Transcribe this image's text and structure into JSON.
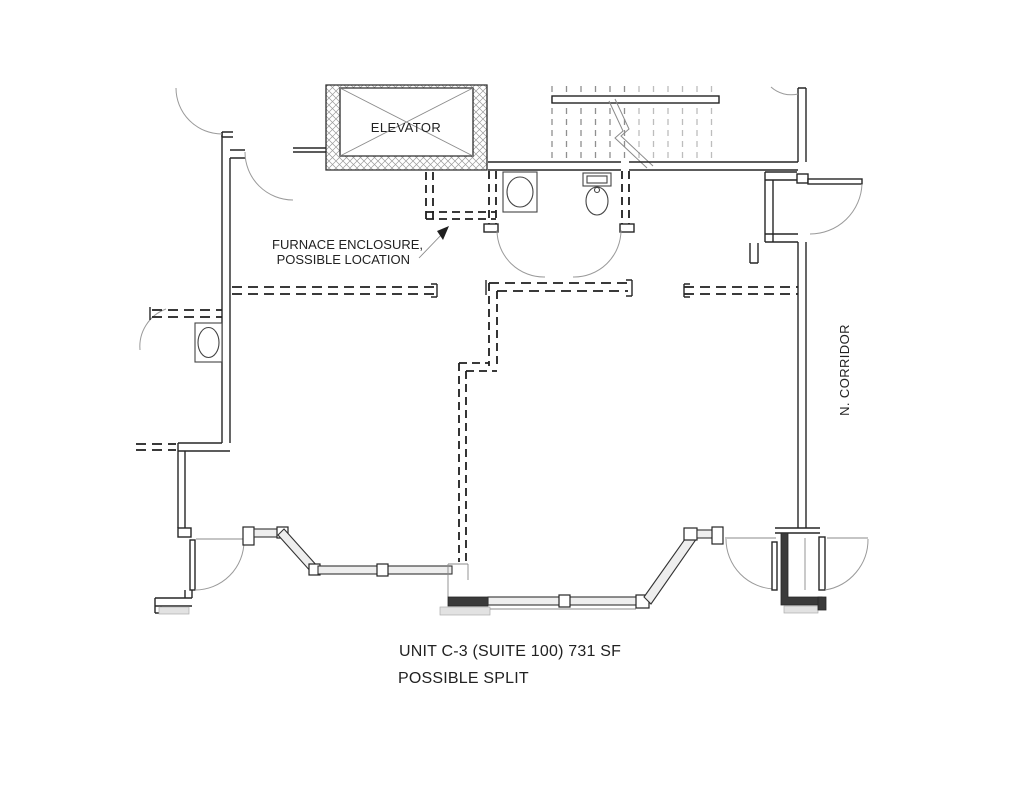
{
  "drawing": {
    "labels": {
      "elevator": "ELEVATOR",
      "furnace_line1": "FURNACE ENCLOSURE,",
      "furnace_line2": "POSSIBLE LOCATION",
      "corridor": "N. CORRIDOR",
      "title_line1": "UNIT C-3 (SUITE 100) 731 SF",
      "title_line2": "POSSIBLE SPLIT"
    },
    "colors": {
      "wall_line": "#262626",
      "dashed_wall": "#1f1f1f",
      "stair_tread": "#8f8f8f",
      "hatch": "#9a9a9a",
      "sill": "#e2e2e2",
      "background": "#ffffff"
    },
    "features": [
      "elevator-shaft",
      "stair-run",
      "restroom-sink",
      "restroom-toilet",
      "neighbor-sink",
      "furnace-enclosure-dashed",
      "possible-split-dashed-walls",
      "storefront-bay-windows",
      "entry-vestibule-double-doors",
      "north-corridor"
    ]
  }
}
